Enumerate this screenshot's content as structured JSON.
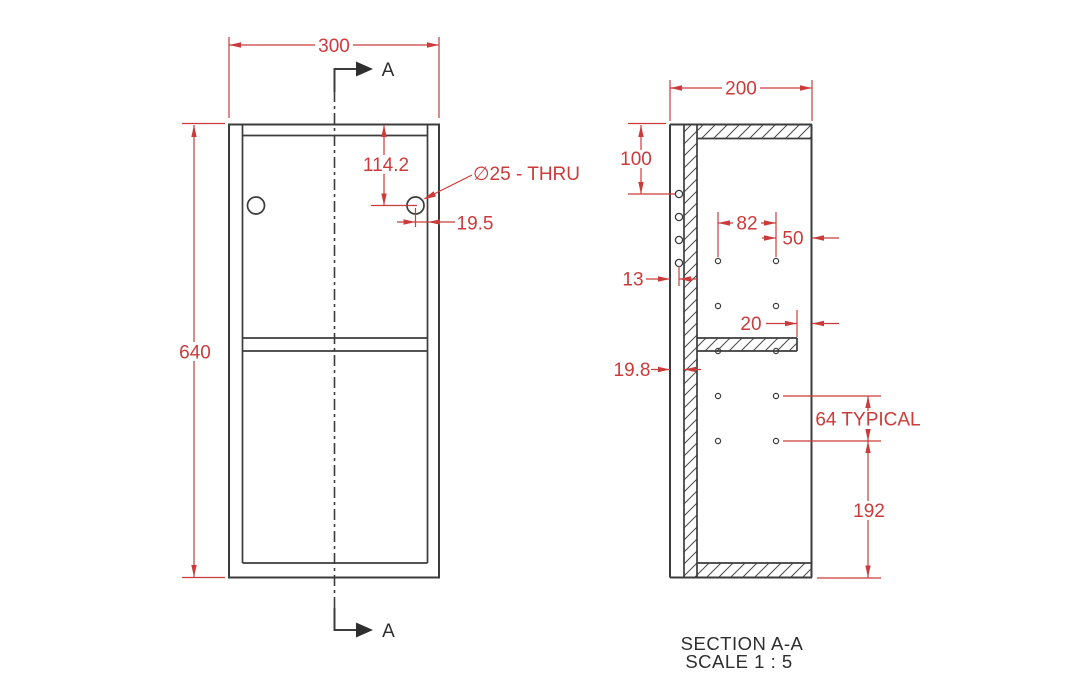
{
  "front_view": {
    "width": "300",
    "height": "640",
    "hole_vertical": "114.2",
    "hole_edge": "19.5",
    "hole_callout": "∅25 - THRU",
    "section_letter": "A"
  },
  "section_view": {
    "depth": "200",
    "top_offset": "100",
    "hole_span": "82",
    "front_offset": "50",
    "back_hole_offset": "13",
    "shelf_setback": "20",
    "panel_thickness": "19.8",
    "typical_spacing": "64 TYPICAL",
    "bottom_offset": "192",
    "title": "SECTION A-A",
    "scale_note": "SCALE 1 : 5"
  },
  "colors": {
    "dimension": "#cc3b3b",
    "geometry": "#3c3c3c",
    "background": "#ffffff"
  }
}
